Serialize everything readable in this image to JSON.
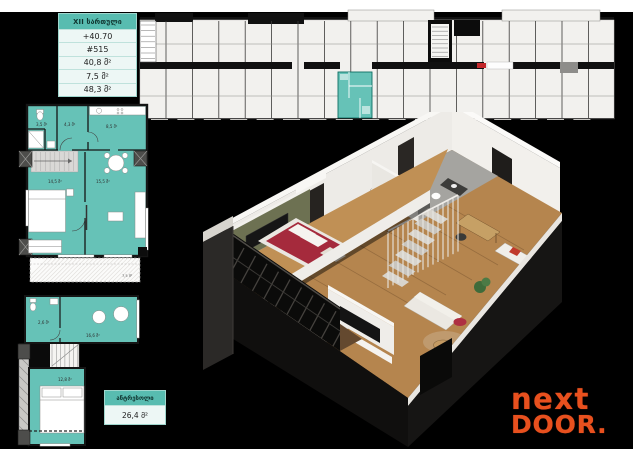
{
  "colors": {
    "teal": "#66C2B7",
    "teal_header": "#58BCB0",
    "row_bg": "#EDF7F5",
    "orange": "#E8501E",
    "board_black": "#000000",
    "wood": "#B5854E",
    "wood_light": "#C09055",
    "green_wall": "#6D7152",
    "bed_red": "#A52A3C",
    "strip_bg": "#F2F1EE",
    "stair_gray": "#D9D8D6"
  },
  "info_box": {
    "floor_label": "XII სართული",
    "rows": [
      "+40.70",
      "#515",
      "40,8 მ²",
      "7,5 მ²",
      "48,3 მ²"
    ]
  },
  "mezzanine_box": {
    "title": "ანტრესოლი",
    "area": "26,4 მ²"
  },
  "main_plan": {
    "room_labels": [
      "3,5 მ²",
      "4,3 მ²",
      "8,5 მ²",
      "14,5 მ²",
      "15,5 მ²"
    ],
    "balcony_label": "7,5 მ²"
  },
  "mezz_plan": {
    "room_labels": [
      "2,6 მ²",
      "16,6 მ²",
      "12,8 მ²"
    ]
  },
  "logo": {
    "line1": "next",
    "line2": "DOOR."
  }
}
